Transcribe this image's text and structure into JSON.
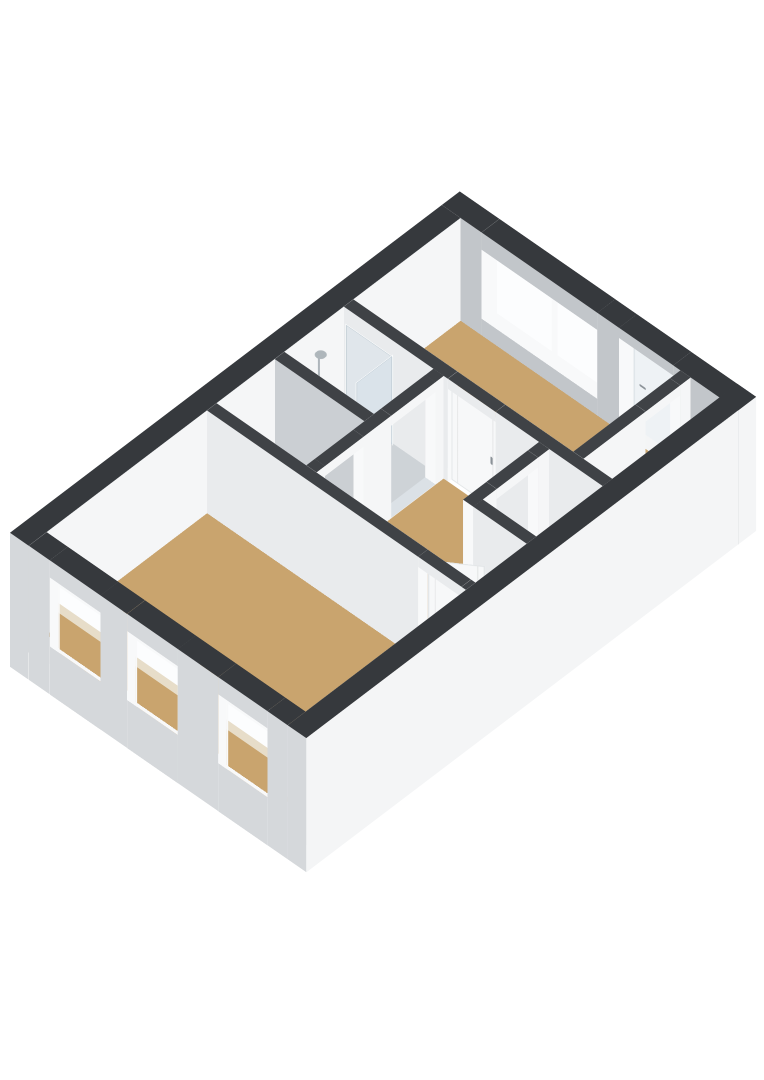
{
  "meta": {
    "description": "3D isometric floor-plan render of one dwelling level, viewed from above at an angle, no text labels",
    "background": "#ffffff"
  },
  "colors": {
    "bg": "#ffffff",
    "extTop": "#36393d",
    "intTop": "#3f4246",
    "extShade": "#d5d8db",
    "extLight": "#f4f5f6",
    "intWhite": "#f5f6f7",
    "intGrayNX": "#c2c6ca",
    "intGrayNY": "#cbcfd3",
    "intShadeNY": "#d2d5d8",
    "intNXlight": "#e9ebed",
    "frameWhite": "#f8f9fa",
    "doorWhite": "#f7f8f9",
    "floorTan": "#c9a46e",
    "sandLight": "#e7ddc9",
    "floorBlue": "#c2ccd4",
    "floorGray": "#ced3d7",
    "floorWhite": "#f2f3f4",
    "floorThresh": "#dbe1e6",
    "glassLight": "#eef2f5",
    "glassWhite": "#fcfdfe",
    "chrome": "#aeb6bb",
    "handle": "#8b9298",
    "trayGray": "#e6e9eb",
    "trayEdge": "#d3d7da",
    "porcTop": "#eef0f2",
    "porcLight": "#f8f9fb",
    "porcShade": "#dde1e4",
    "bowlShadow": "#d9dde0"
  },
  "scene": {
    "rooms": [
      {
        "id": "living-room",
        "floor": "floorTan",
        "windows": 3
      },
      {
        "id": "toilet-room",
        "floor": "floorBlue",
        "fixtures": [
          "toilet"
        ]
      },
      {
        "id": "shower-room",
        "floor": "floorGray",
        "fixtures": [
          "shower-cabin"
        ]
      },
      {
        "id": "hall",
        "floor": "floorTan"
      },
      {
        "id": "closet",
        "floor": "floorWhite"
      },
      {
        "id": "bedroom",
        "floor": "floorTan",
        "windows": 1
      },
      {
        "id": "storage-strip",
        "floor": "floorWhite"
      }
    ],
    "openings": {
      "west_wall_windows": 3,
      "bedroom_window_sashes": 2,
      "balcony_door": 1,
      "interior_door_leaves": 2,
      "open_doorways": 4
    }
  }
}
